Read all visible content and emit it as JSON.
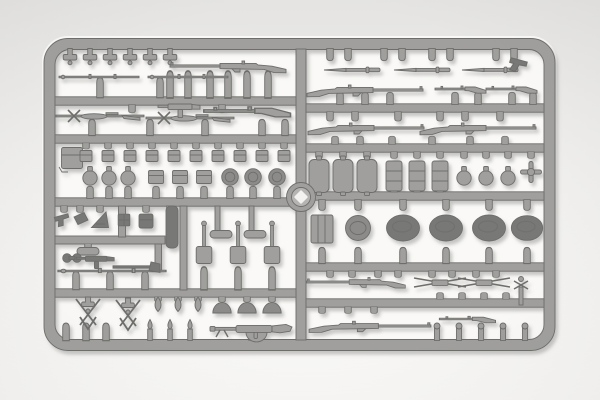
{
  "scene": {
    "type": "photograph",
    "subject": "gray injection-molded plastic sprue (model-kit parts frame) with miniature weapons and field equipment",
    "background": "plain light studio backdrop",
    "orientation": "sprue fills frame horizontally, rounded-corner rectangular outer runner, one central vertical runner dividing left and right halves, circular molding hub at center"
  },
  "sprue_inventory": {
    "top_left": [
      "6 mushroom sprue posts",
      "2 thin cleaning rods",
      "1 long rifle"
    ],
    "upper_left": [
      "2 scoped rifles with folded bipods",
      "1 submachine gun",
      "1 carbine with stock"
    ],
    "mid_left": [
      "10 small ammunition pouches",
      "1 pack box",
      "3 round canteens",
      "3 large pouches",
      "3 mess-tin lids"
    ],
    "lower_left": [
      "1 holster",
      "1 wedge pouch",
      "1 triangular pouch",
      "1 gridded pouch",
      "1 rectangular pouch",
      "1 capsule tool",
      "1 dark hand tool",
      "1 hatchet",
      "1 long rod",
      "1 scabbard",
      "3 entrenching shovels with loop handles"
    ],
    "bottom_left": [
      "2 crossed-pick chevron assemblies",
      "3 flame finials",
      "3 helmet domes",
      "3 plain posts",
      "3 spear-tip posts",
      "1 light machine gun with drum magazine"
    ],
    "top_right": [
      "8 hanging posts",
      "3 bayonets",
      "1 holster wedge",
      "3 long rifles",
      "2 carbines"
    ],
    "mid_right": [
      "3 rectangular flasks",
      "3 ribbed cylindrical canteens",
      "3 capped round canteens",
      "1 cross fitting",
      "1 ribbed cup",
      "1 round mess-tin lid",
      "4 oval helmets"
    ],
    "bottom_right": [
      "2 long rifles",
      "2 crossed cleaning-rod sets",
      "1 winged valve stem",
      "1 small carbine",
      "5 ball-top posts"
    ],
    "center": [
      "circular molding hub with light diamond mark"
    ]
  },
  "colors": {
    "backdrop_top": "#e5e4e2",
    "backdrop_mid": "#efeeec",
    "backdrop_bottom": "#f9f8f6",
    "interior": "#faf9f7",
    "plastic": "#a09f9d",
    "plastic_edge": "#6d6d6b",
    "plastic_dark": "#787876",
    "plastic_mid": "#8c8b89",
    "plastic_light": "#b5b4b2",
    "hub_label": "#f3f2f0",
    "shadow": "#8f8e8c"
  }
}
